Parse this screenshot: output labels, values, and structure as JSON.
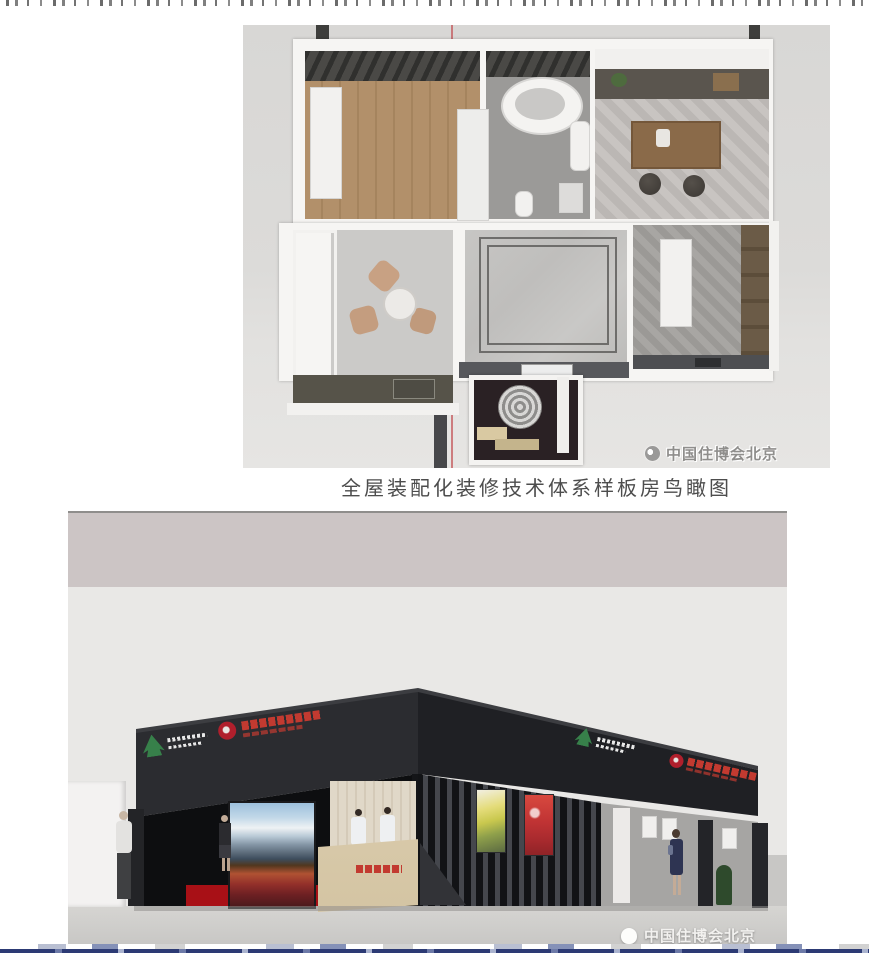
{
  "figures": {
    "floor_plan": {
      "caption": "全屋装配化装修技术体系样板房鸟瞰图",
      "watermark": "中国住博会北京"
    },
    "booth": {
      "watermark": "中国住博会北京"
    }
  },
  "colors": {
    "page_bg": "#ffffff",
    "plan_bg": "#dcdbd9",
    "booth_dark": "#26272b",
    "carpet_red": "#a81016",
    "strip_navy": "#2c3a74"
  }
}
